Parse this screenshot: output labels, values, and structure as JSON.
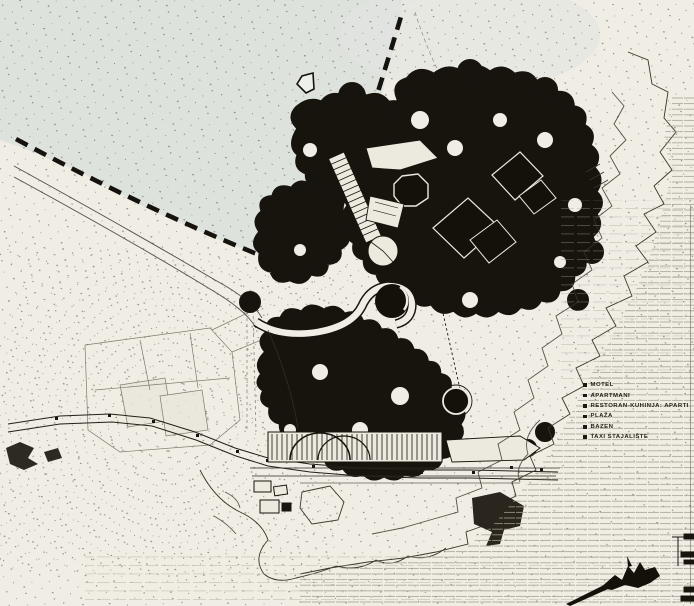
{
  "figure": {
    "kind": "scanned architectural site plan of a coastal tourist complex",
    "palette": {
      "paper": "#f0ede4",
      "sea": "#dee2dd",
      "ink": "#17140e",
      "canopy": "#17140e",
      "sea_hatch_line": "#a49e92",
      "faint_line": "#6b665c"
    },
    "icons": {
      "direction_arrow": "hollow pentagon arrow pointing left",
      "legend_bullet": "■"
    }
  },
  "legend": {
    "items": [
      {
        "bullet": "■",
        "label": "MOTEL"
      },
      {
        "bullet": "■",
        "label": "APARTMANI"
      },
      {
        "bullet": "■",
        "label": "RESTORAN-KUHINJA: APARTI"
      },
      {
        "bullet": "■",
        "label": "PLAŽA"
      },
      {
        "bullet": "■",
        "label": "BAZEN"
      },
      {
        "bullet": "■",
        "label": "TAXI STAJALIŠTE"
      }
    ]
  }
}
